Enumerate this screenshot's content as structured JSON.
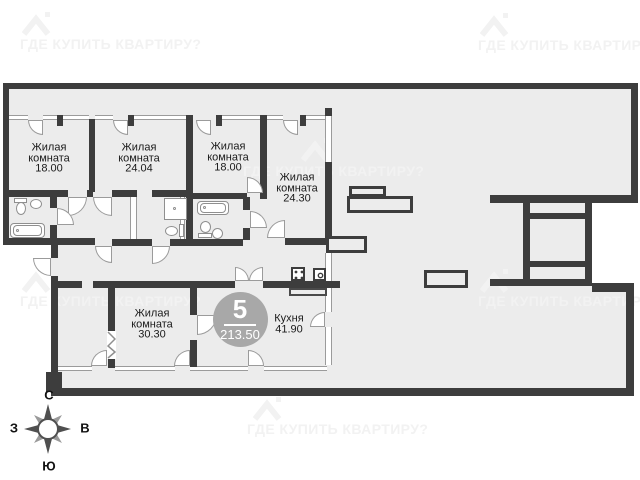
{
  "watermark": {
    "text": "ГДЕ КУПИТЬ КВАРТИРУ?",
    "positions": [
      {
        "tx": 20,
        "ty": 36,
        "ix": 22,
        "iy": 10
      },
      {
        "tx": 478,
        "ty": 37,
        "ix": 480,
        "iy": 11
      },
      {
        "tx": 243,
        "ty": 163,
        "ix": 301,
        "iy": 136
      },
      {
        "tx": 20,
        "ty": 293,
        "ix": 22,
        "iy": 267
      },
      {
        "tx": 478,
        "ty": 293,
        "ix": 480,
        "iy": 267
      },
      {
        "tx": 247,
        "ty": 421,
        "ix": 253,
        "iy": 395
      }
    ]
  },
  "badge": {
    "rooms_count": "5",
    "total_area": "213.50",
    "cx": 240,
    "cy": 319,
    "r": 27.5
  },
  "compass": {
    "north": "С",
    "south": "Ю",
    "west": "З",
    "east": "В",
    "cx": 48,
    "cy": 429
  },
  "rooms": [
    {
      "label_lines": [
        "Жилая",
        "комната"
      ],
      "area": "18.00",
      "cx": 49,
      "cy": 158
    },
    {
      "label_lines": [
        "Жилая",
        "комната"
      ],
      "area": "24.04",
      "cx": 139,
      "cy": 158
    },
    {
      "label_lines": [
        "Жилая",
        "комната"
      ],
      "area": "18.00",
      "cx": 228,
      "cy": 157
    },
    {
      "label_lines": [
        "Жилая",
        "комната"
      ],
      "area": "24.30",
      "cx": 297,
      "cy": 188
    },
    {
      "label_lines": [
        "Жилая",
        "комната"
      ],
      "area": "30.30",
      "cx": 152,
      "cy": 324
    },
    {
      "label_lines": [
        "Кухня"
      ],
      "area": "41.90",
      "cx": 289,
      "cy": 324
    }
  ],
  "plan": {
    "colors": {
      "wall": "#3d3d3d",
      "floor": "#ececec",
      "line": "#9b9b9b",
      "fixture": "#8f8f8f"
    },
    "floors": [
      [
        6,
        86,
        625,
        33
      ],
      [
        6,
        86,
        326,
        204
      ],
      [
        332,
        86,
        299,
        200
      ],
      [
        54,
        286,
        572,
        104
      ]
    ],
    "voids": [
      [
        592,
        203,
        46,
        80
      ],
      [
        0,
        245,
        51,
        235
      ]
    ],
    "walls": [
      [
        3,
        83,
        635,
        6
      ],
      [
        631,
        83,
        7,
        120
      ],
      [
        3,
        83,
        6,
        162
      ],
      [
        3,
        238,
        92,
        7
      ],
      [
        51,
        245,
        7,
        13
      ],
      [
        51,
        276,
        7,
        96
      ],
      [
        46,
        372,
        16,
        20
      ],
      [
        51,
        388,
        583,
        8
      ],
      [
        626,
        286,
        8,
        110
      ],
      [
        89,
        119,
        6,
        73
      ],
      [
        186,
        115,
        7,
        124
      ],
      [
        260,
        115,
        7,
        77
      ],
      [
        325,
        108,
        7,
        8
      ],
      [
        325,
        162,
        7,
        76
      ],
      [
        57,
        115,
        6,
        11
      ],
      [
        128,
        115,
        6,
        11
      ],
      [
        216,
        115,
        6,
        11
      ],
      [
        300,
        115,
        6,
        11
      ],
      [
        3,
        190,
        65,
        7
      ],
      [
        87,
        190,
        6,
        7
      ],
      [
        112,
        190,
        25,
        7
      ],
      [
        152,
        190,
        41,
        7
      ],
      [
        193,
        193,
        54,
        6
      ],
      [
        260,
        190,
        7,
        9
      ],
      [
        50,
        197,
        7,
        11
      ],
      [
        50,
        225,
        7,
        13
      ],
      [
        243,
        197,
        7,
        13
      ],
      [
        243,
        228,
        7,
        12
      ],
      [
        112,
        239,
        40,
        7
      ],
      [
        170,
        239,
        73,
        7
      ],
      [
        285,
        238,
        47,
        7
      ],
      [
        58,
        281,
        24,
        7
      ],
      [
        93,
        281,
        142,
        7
      ],
      [
        263,
        281,
        77,
        7
      ],
      [
        108,
        288,
        7,
        44
      ],
      [
        108,
        358,
        7,
        10
      ],
      [
        190,
        288,
        7,
        27
      ],
      [
        190,
        340,
        7,
        27
      ],
      [
        490,
        195,
        148,
        8
      ],
      [
        523,
        203,
        7,
        82
      ],
      [
        585,
        203,
        7,
        82
      ],
      [
        530,
        213,
        55,
        6
      ],
      [
        530,
        261,
        55,
        6
      ],
      [
        490,
        279,
        102,
        7
      ],
      [
        592,
        283,
        42,
        9
      ]
    ],
    "windows_h": [
      [
        9,
        115,
        19
      ],
      [
        43,
        115,
        14
      ],
      [
        63,
        115,
        26
      ],
      [
        95,
        115,
        18
      ],
      [
        133,
        115,
        53
      ],
      [
        222,
        115,
        38
      ],
      [
        267,
        115,
        16
      ],
      [
        306,
        115,
        19
      ],
      [
        58,
        366,
        34
      ],
      [
        115,
        366,
        60
      ],
      [
        190,
        366,
        58
      ],
      [
        264,
        366,
        63
      ]
    ],
    "windows_v": [
      [
        3,
        158,
        6,
        22
      ],
      [
        130,
        197,
        7,
        42
      ],
      [
        180,
        193,
        5,
        46
      ],
      [
        325,
        114,
        7,
        48
      ],
      [
        325,
        253,
        7,
        28
      ],
      [
        325,
        288,
        7,
        24
      ],
      [
        325,
        327,
        7,
        38
      ]
    ],
    "arcs": [
      [
        28,
        120,
        15,
        "bl"
      ],
      [
        113,
        120,
        15,
        "bl"
      ],
      [
        196,
        120,
        15,
        "bl"
      ],
      [
        283,
        120,
        15,
        "bl"
      ],
      [
        68,
        197,
        19,
        "br"
      ],
      [
        93,
        197,
        19,
        "bl"
      ],
      [
        57,
        208,
        17,
        "tr"
      ],
      [
        95,
        246,
        17,
        "bl"
      ],
      [
        152,
        246,
        18,
        "br"
      ],
      [
        250,
        211,
        17,
        "tr"
      ],
      [
        247,
        177,
        16,
        "tr"
      ],
      [
        267,
        220,
        18,
        "tl"
      ],
      [
        235,
        267,
        14,
        "tr"
      ],
      [
        249,
        267,
        14,
        "tl"
      ],
      [
        33,
        258,
        18,
        "bl"
      ],
      [
        197,
        315,
        20,
        "br"
      ],
      [
        310,
        312,
        15,
        "tl"
      ],
      [
        91,
        350,
        16,
        "tl"
      ],
      [
        174,
        350,
        16,
        "tl"
      ],
      [
        248,
        350,
        16,
        "tr"
      ]
    ],
    "bars": [
      [
        349,
        186,
        37,
        11
      ],
      [
        347,
        196,
        66,
        17
      ],
      [
        326,
        236,
        41,
        17
      ],
      [
        424,
        270,
        44,
        18
      ]
    ],
    "fixtures": [
      {
        "t": "rr",
        "x": 10,
        "y": 223,
        "w": 35,
        "h": 15
      },
      {
        "t": "rr",
        "x": 13,
        "y": 225,
        "w": 29,
        "h": 11
      },
      {
        "t": "dot",
        "x": 16,
        "y": 229
      },
      {
        "t": "rect",
        "x": 14,
        "y": 198,
        "w": 13,
        "h": 5
      },
      {
        "t": "ell",
        "x": 16,
        "y": 202,
        "w": 10,
        "h": 13
      },
      {
        "t": "ell",
        "x": 30,
        "y": 199,
        "w": 12,
        "h": 10
      },
      {
        "t": "rect",
        "x": 164,
        "y": 198,
        "w": 23,
        "h": 22
      },
      {
        "t": "dot",
        "x": 173,
        "y": 207
      },
      {
        "t": "ell",
        "x": 165,
        "y": 226,
        "w": 13,
        "h": 10
      },
      {
        "t": "rect",
        "x": 179,
        "y": 224,
        "w": 5,
        "h": 13
      },
      {
        "t": "rr",
        "x": 197,
        "y": 201,
        "w": 32,
        "h": 14
      },
      {
        "t": "rr",
        "x": 200,
        "y": 203,
        "w": 26,
        "h": 10
      },
      {
        "t": "dot",
        "x": 203,
        "y": 206
      },
      {
        "t": "ell",
        "x": 200,
        "y": 221,
        "w": 11,
        "h": 12
      },
      {
        "t": "rect",
        "x": 198,
        "y": 233,
        "w": 14,
        "h": 5
      },
      {
        "t": "ell",
        "x": 212,
        "y": 228,
        "w": 11,
        "h": 11
      }
    ],
    "kitchen": {
      "counter": {
        "x": 289,
        "y": 288,
        "w": 38,
        "h": 8
      },
      "stove": {
        "x": 291,
        "y": 267,
        "w": 14,
        "h": 14
      },
      "sink": {
        "x": 313,
        "y": 268,
        "w": 13,
        "h": 13
      }
    },
    "zigzag": {
      "x": 107,
      "y": 331,
      "w": 9,
      "h": 28
    }
  }
}
